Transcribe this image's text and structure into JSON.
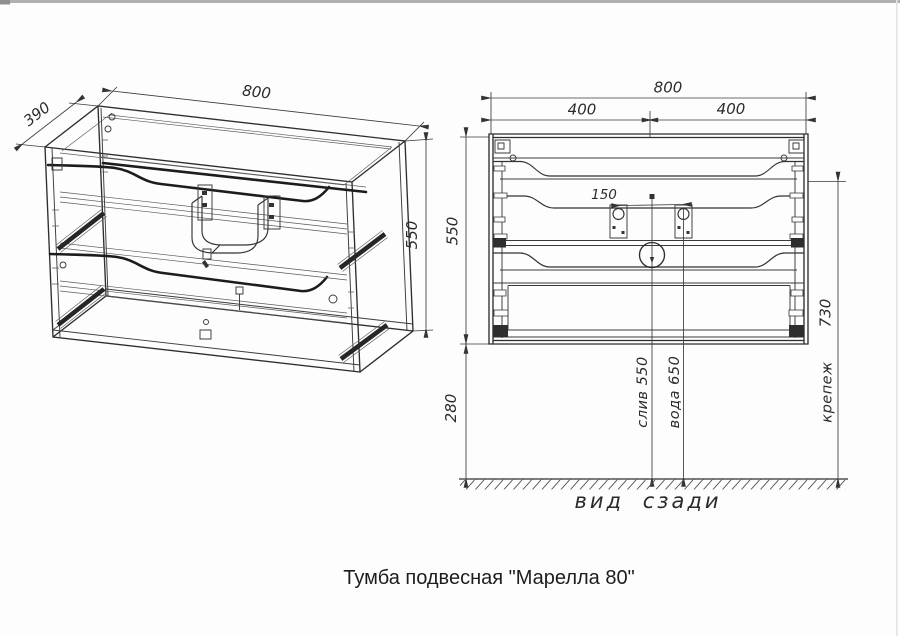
{
  "page": {
    "background": "#fdfdfd",
    "ink_color": "#2b2b2b",
    "caption": "Тумба подвесная \"Марелла 80\""
  },
  "isometric_view": {
    "dim_width": "800",
    "dim_depth": "390",
    "dim_height": "550"
  },
  "rear_view": {
    "dim_overall_width": "800",
    "dim_left_half": "400",
    "dim_right_half": "400",
    "dim_bracket_spacing": "150",
    "dim_height": "550",
    "dim_fastener_height": "730",
    "dim_floor_clearance": "280",
    "label_drain": "слив 550",
    "label_water": "вода 650",
    "label_fastener": "крепеж",
    "label_view": "вид сзади"
  }
}
